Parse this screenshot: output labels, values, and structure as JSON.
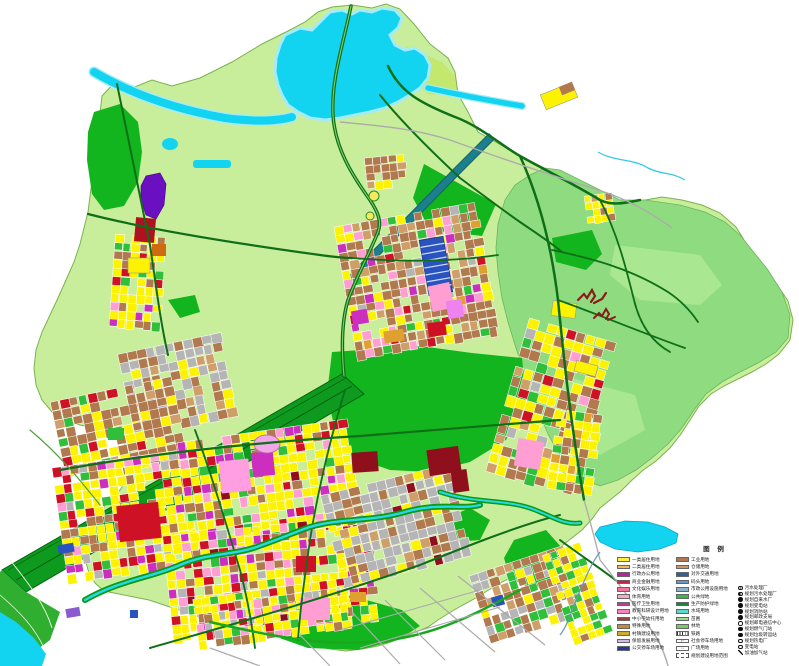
{
  "legend": {
    "title": "图 例",
    "col1": [
      {
        "label": "一类居住用地",
        "color": "#ffef45"
      },
      {
        "label": "二类居住用地",
        "color": "#f2b95e"
      },
      {
        "label": "行政办公用地",
        "color": "#bb22a0"
      },
      {
        "label": "商业金融用地",
        "color": "#cc2244"
      },
      {
        "label": "文化娱乐用地",
        "color": "#ee7799"
      },
      {
        "label": "体育用地",
        "color": "#f4aacc"
      },
      {
        "label": "医疗卫生用地",
        "color": "#cc3399"
      },
      {
        "label": "教育科研设计用地",
        "color": "#ee88bb"
      },
      {
        "label": "中小学幼托用地",
        "color": "#994444"
      },
      {
        "label": "特殊用地",
        "color": "#cc8833"
      },
      {
        "label": "村镇建设用地",
        "color": "#ccaa33"
      },
      {
        "label": "保留发展用地",
        "color": "#d8b8ee"
      },
      {
        "label": "公交停车场用地",
        "color": "#223a99"
      }
    ],
    "col2": [
      {
        "label": "工业用地",
        "color": "#b07850"
      },
      {
        "label": "仓储用地",
        "color": "#cc9966"
      },
      {
        "label": "对外交通用地",
        "color": "#335f99"
      },
      {
        "label": "码头用地",
        "color": "#6699cc"
      },
      {
        "label": "市政公用设施用地",
        "color": "#8fb3cc"
      },
      {
        "label": "公共绿地",
        "color": "#33bb44"
      },
      {
        "label": "生产防护绿地",
        "color": "#118833"
      },
      {
        "label": "水域用地",
        "color": "#55ddcc"
      },
      {
        "label": "苗圃",
        "color": "#99dd88"
      },
      {
        "label": "林地",
        "color": "#77cc66"
      },
      {
        "label": "铁路",
        "color": "#ffffff",
        "pattern": "hatch"
      },
      {
        "label": "社会停车场用地",
        "color": "#ffffff",
        "pattern": "glyph",
        "glyph": "P"
      },
      {
        "label": "广场用地",
        "color": "#ffffff",
        "pattern": "glyph",
        "glyph": "□"
      },
      {
        "label": "规划建设用地范围",
        "color": "#ffffff",
        "pattern": "dashed"
      }
    ],
    "facilities": [
      {
        "label": "污水处理厂",
        "symbol": "ringdot"
      },
      {
        "label": "规划污水处理厂",
        "symbol": "half"
      },
      {
        "label": "规划自来水厂",
        "symbol": "filled"
      },
      {
        "label": "规划变电站",
        "symbol": "filled"
      },
      {
        "label": "规划消防站",
        "symbol": "filled"
      },
      {
        "label": "规划邮政支局",
        "symbol": "filled"
      },
      {
        "label": "规划邮电通信中心",
        "symbol": "open"
      },
      {
        "label": "规划燃气门站",
        "symbol": "filled"
      },
      {
        "label": "规划垃圾转运站",
        "symbol": "filled"
      },
      {
        "label": "规划热电厂",
        "symbol": "open"
      },
      {
        "label": "变电站",
        "symbol": "open"
      },
      {
        "label": "加油加气站",
        "symbol": "slash"
      }
    ]
  },
  "map": {
    "palette": {
      "base": "#c9ee9b",
      "hills": "#8fdc80",
      "hillsLight": "#a9e890",
      "park": "#12b51e",
      "corridor": "#0d9a1e",
      "cornerGreen": "#2fae2f",
      "water": "#12d4f0",
      "waterHalo": "#a5ebf7",
      "road": "#0e6f17",
      "roadInner": "#7fd06a",
      "roadMinor": "#4f9f3f",
      "roadGray": "#ababab",
      "canal": "#1d7f8c",
      "canalEdge": "#14616b",
      "boundary": "#7ab24d",
      "antler": "#8b1a1a",
      "interchange": "#f5e95c",
      "blocks": {
        "Y1": "#fdf200",
        "Y2": "#fff9a6",
        "BR": "#b1794e",
        "TN": "#cf9f6a",
        "RD": "#cf1126",
        "DR": "#8f0f1d",
        "MG": "#cc2fbf",
        "PK": "#ff9ed2",
        "OR": "#ee82ee",
        "GY": "#b5b5b5",
        "GN": "#2fbf3a",
        "BL": "#2b53c0",
        "OG": "#e0a030",
        "VT": "#6a10c0"
      }
    }
  }
}
